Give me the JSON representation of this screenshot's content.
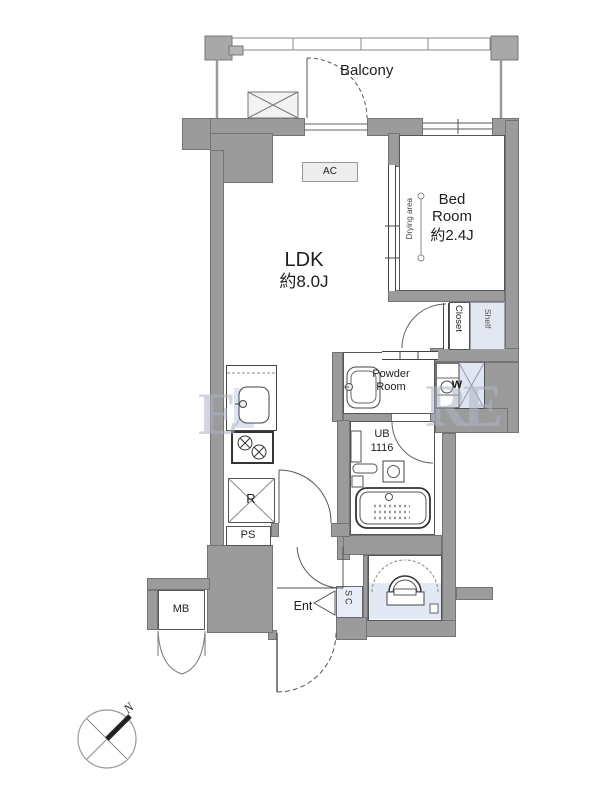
{
  "rooms": {
    "balcony": "Balcony",
    "ldk_name": "LDK",
    "ldk_size": "約8.0J",
    "bedroom_name": "Bed Room",
    "bedroom_size": "約2.4J",
    "drying_area": "Drying area",
    "closet": "Closet",
    "shelf": "Shelf",
    "powder_room": "Powder Room",
    "washer": "W",
    "bath_name": "UB",
    "bath_size": "1116",
    "ac": "AC",
    "fridge": "R",
    "pipe_space": "PS",
    "meter_box": "MB",
    "entrance": "Ent",
    "shoe_closet": "SC"
  },
  "compass": {
    "north_label": "N"
  },
  "watermark": {
    "letters": [
      "E",
      "R",
      "E"
    ]
  },
  "colors": {
    "wall": "#9b9b9b",
    "outline": "#747474",
    "wet_tint": "#dfe5f1",
    "storage_tint": "#e3e7f0",
    "light_fill": "#ededed",
    "watermark": "#adb3c2"
  }
}
